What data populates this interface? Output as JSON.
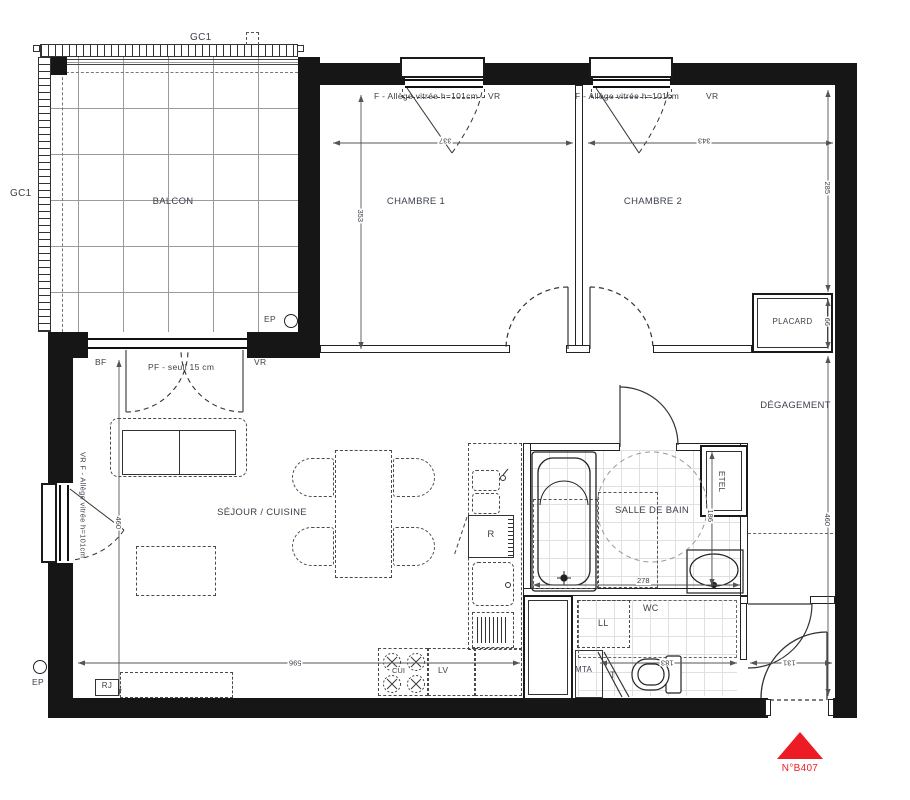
{
  "plan": {
    "rooms": {
      "balcon": "BALCON",
      "chambre1": "CHAMBRE 1",
      "chambre2": "CHAMBRE 2",
      "sejour": "SÉJOUR / CUISINE",
      "salle_de_bain": "SALLE DE BAIN",
      "degagement": "DÉGAGEMENT",
      "placard": "PLACARD",
      "wc": "WC"
    },
    "labels": {
      "gc1_top": "GC1",
      "gc1_left": "GC1",
      "window1": "F - Allège vitrée h=101cm",
      "window1_vr": "VR",
      "window2": "F - Allège vitrée h=101cm",
      "window2_vr": "VR",
      "left_window": "VR  F - Allège vitrée h=101cm",
      "bf": "BF",
      "pf_seuil": "PF - seuil 15 cm",
      "pf_vr": "VR",
      "ep_top": "EP",
      "ep_bottom": "EP",
      "rj": "RJ",
      "etel": "ETEL",
      "ll": "LL",
      "mta": "MTA",
      "t": "T",
      "r": "R",
      "cui": "CUI",
      "lv": "LV",
      "plan_number": "N°B407"
    },
    "dims": {
      "chambre1_width": "337",
      "chambre2_width": "343",
      "chambre1_depth": "353",
      "chambre2_depth": "285",
      "placard_depth": "66",
      "degagement_height": "460",
      "sejour_height": "460",
      "sejour_width": "596",
      "wc_width": "183",
      "entree_width": "131",
      "sdb_width": "278",
      "sdb_height": "186"
    },
    "colors": {
      "wall": "#161616",
      "label": "#3c414b",
      "accent_red": "#ed1c24"
    }
  }
}
